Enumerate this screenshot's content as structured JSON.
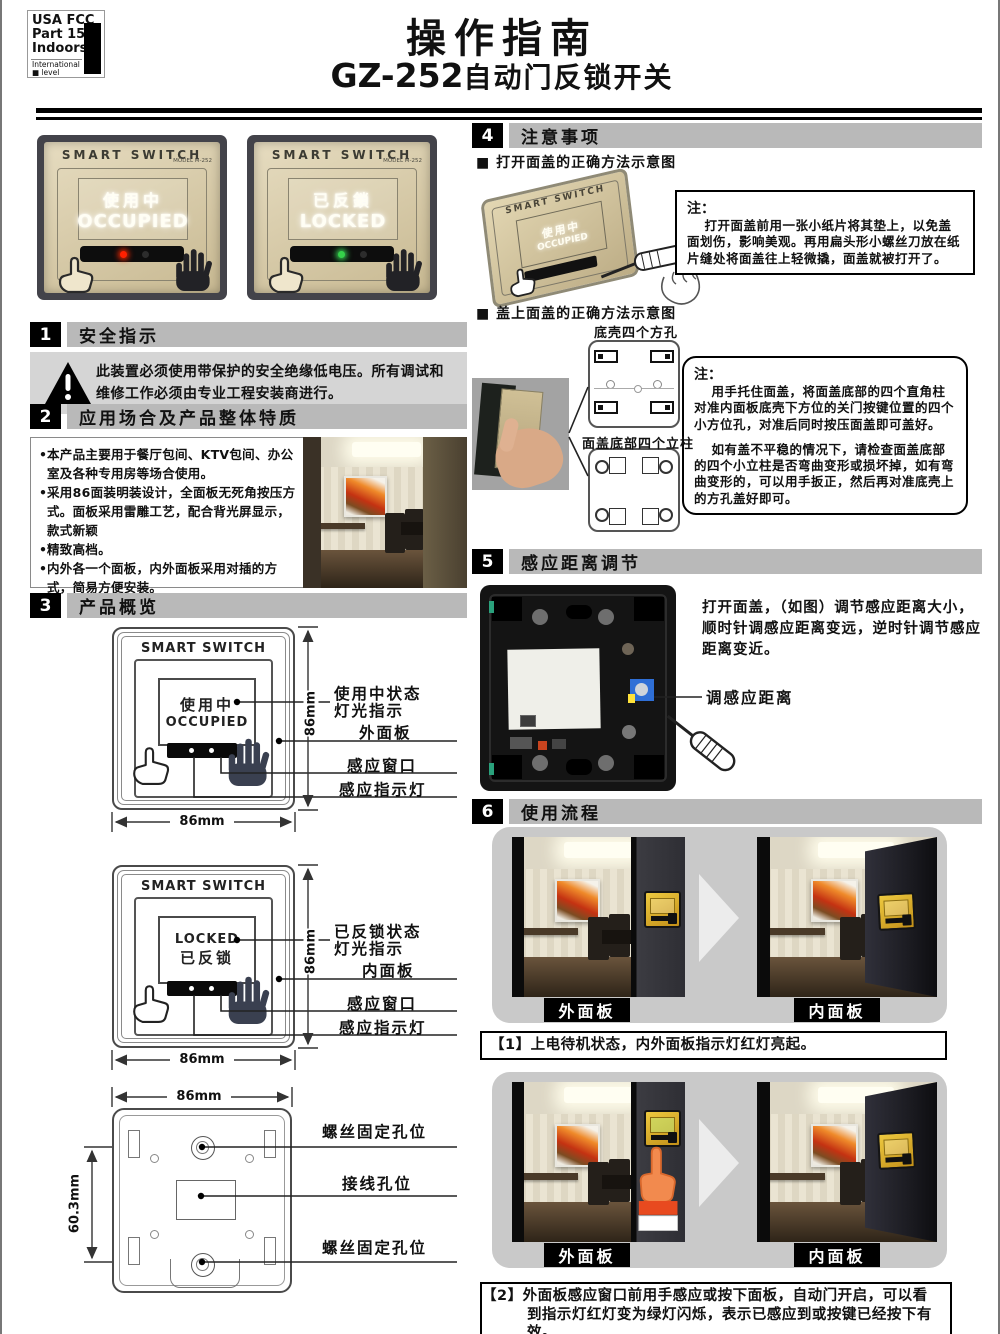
{
  "colors": {
    "header_bar": "#b9b9b9",
    "warning_bg": "#d5d5d5",
    "panel_gold": "#d3c5a2",
    "led_red": "#ff2000",
    "led_green": "#35d14a",
    "pot_blue": "#2f6fd6",
    "flow_bg": "#c9c9c9",
    "switch_gold": "#d9a81e",
    "hand_orange": "#f08a4b"
  },
  "header": {
    "logo": {
      "l1": "USA FCC",
      "l2": "Part 15",
      "l3": "Indoors",
      "l4": "International",
      "l5": "■ level"
    },
    "title": "操作指南",
    "model": "GZ-252",
    "subtitle": "自动门反锁开关"
  },
  "product_photos": {
    "brand": "SMART  SWITCH",
    "model_small": "MODEL M-252",
    "occupied": {
      "cn": "使用中",
      "en": "OCCUPIED"
    },
    "locked": {
      "cn": "已反鎖",
      "en": "LOCKED"
    }
  },
  "s1": {
    "num": "1",
    "title": "安全指示",
    "warning": "此装置必须使用带保护的安全绝缘低电压。所有调试和维修工作必须由专业工程安装商进行。"
  },
  "s2": {
    "num": "2",
    "title": "应用场合及产品整体特质",
    "bullets": [
      "本产品主要用于餐厅包间、KTV包间、办公室及各种专用房等场合使用。",
      "采用86面装明装设计，全面板无死角按压方式。面板采用雷雕工艺，配合背光屏显示，款式新颖",
      "精致高档。",
      "内外各一个面板，内外面板采用对插的方式，简易方便安装。"
    ]
  },
  "s3": {
    "num": "3",
    "title": "产品概览",
    "brand": "SMART SWITCH",
    "d1": {
      "cn": "使用中",
      "en": "OCCUPIED",
      "label_status": "使用中状态\n灯光指示",
      "label_panel": "外面板",
      "label_window": "感应窗口",
      "label_led": "感应指示灯"
    },
    "d2": {
      "en": "LOCKED",
      "cn": "已反锁",
      "label_status": "已反锁状态\n灯光指示",
      "label_panel": "内面板",
      "label_window": "感应窗口",
      "label_led": "感应指示灯"
    },
    "d3": {
      "label_screw_top": "螺丝固定孔位",
      "label_wire": "接线孔位",
      "label_screw_bottom": "螺丝固定孔位"
    },
    "dim_86": "86mm",
    "dim_603": "60.3mm"
  },
  "s4": {
    "num": "4",
    "title": "注意事项",
    "sub1": "■ 打开面盖的正确方法示意图",
    "note_head": "注：",
    "note1": "打开面盖前用一张小纸片将其垫上，以免盖面划伤，影响美观。再用扁头形小螺丝刀放在纸片缝处将面盖往上轻微撬，面盖就被打开了。",
    "sub2": "■ 盖上面盖的正确方法示意图",
    "label_holes": "底壳四个方孔",
    "label_posts": "面盖底部四个立柱",
    "note2a": "用手托住面盖，将面盖底部的四个直角柱对准内面板底壳下方位的关门按键位置的四个小方位孔，对准后同时按压面盖即可盖好。",
    "note2b": "如有盖不平稳的情况下，请检查面盖底部的四个小立柱是否弯曲变形或损坏掉，如有弯曲变形的，可以用手扳正，然后再对准底壳上的方孔盖好即可。"
  },
  "s5": {
    "num": "5",
    "title": "感应距离调节",
    "text": "打开面盖，（如图）调节感应距离大小，顺时针调感应距离变远，逆时针调节感应距离变近。",
    "pointer": "调感应距离"
  },
  "s6": {
    "num": "6",
    "title": "使用流程",
    "outer": "外面板",
    "inner": "内面板",
    "cap1": "【1】上电待机状态，内外面板指示灯红灯亮起。",
    "cap2": "【2】外面板感应窗口前用手感应或按下面板，自动门开启，可以看到指示灯红灯变为绿灯闪烁，表示已感应到或按键已经按下有效。"
  }
}
